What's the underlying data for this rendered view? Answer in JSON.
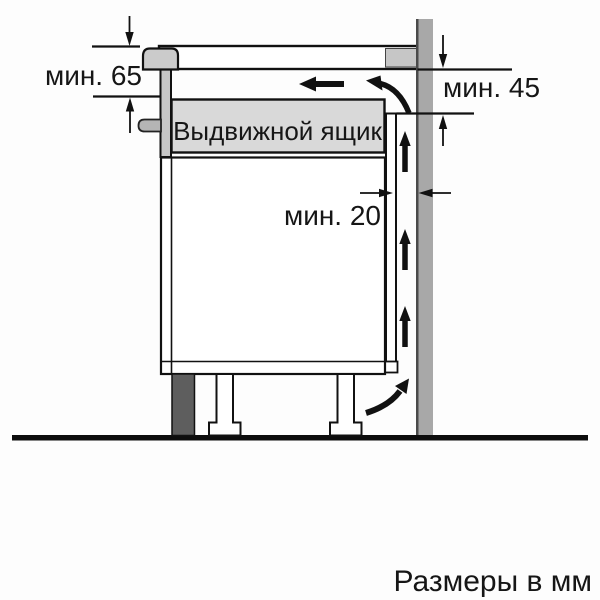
{
  "diagram": {
    "type": "appliance-installation-clearance-diagram",
    "drawer_label": "Выдвижной ящик",
    "footer_note": "Размеры в мм",
    "dimensions": [
      {
        "id": "hob-depth-clearance",
        "label": "мин. 65"
      },
      {
        "id": "rear-top-clearance",
        "label": "мин. 45"
      },
      {
        "id": "wall-gap-clearance",
        "label": "мин. 20"
      }
    ],
    "colors": {
      "wall": "#a8a8a8",
      "wall_edge": "#4a4a4a",
      "counter_block": "#c6c6c6",
      "hob": "#cbcbcb",
      "hob_housing": "#c6c6c6",
      "clip": "#b5b5b5",
      "drawer_fill": "#d9d9d9",
      "plinth": "#5e5e5e",
      "line": "#111111",
      "background": "#fdfdfd"
    }
  }
}
